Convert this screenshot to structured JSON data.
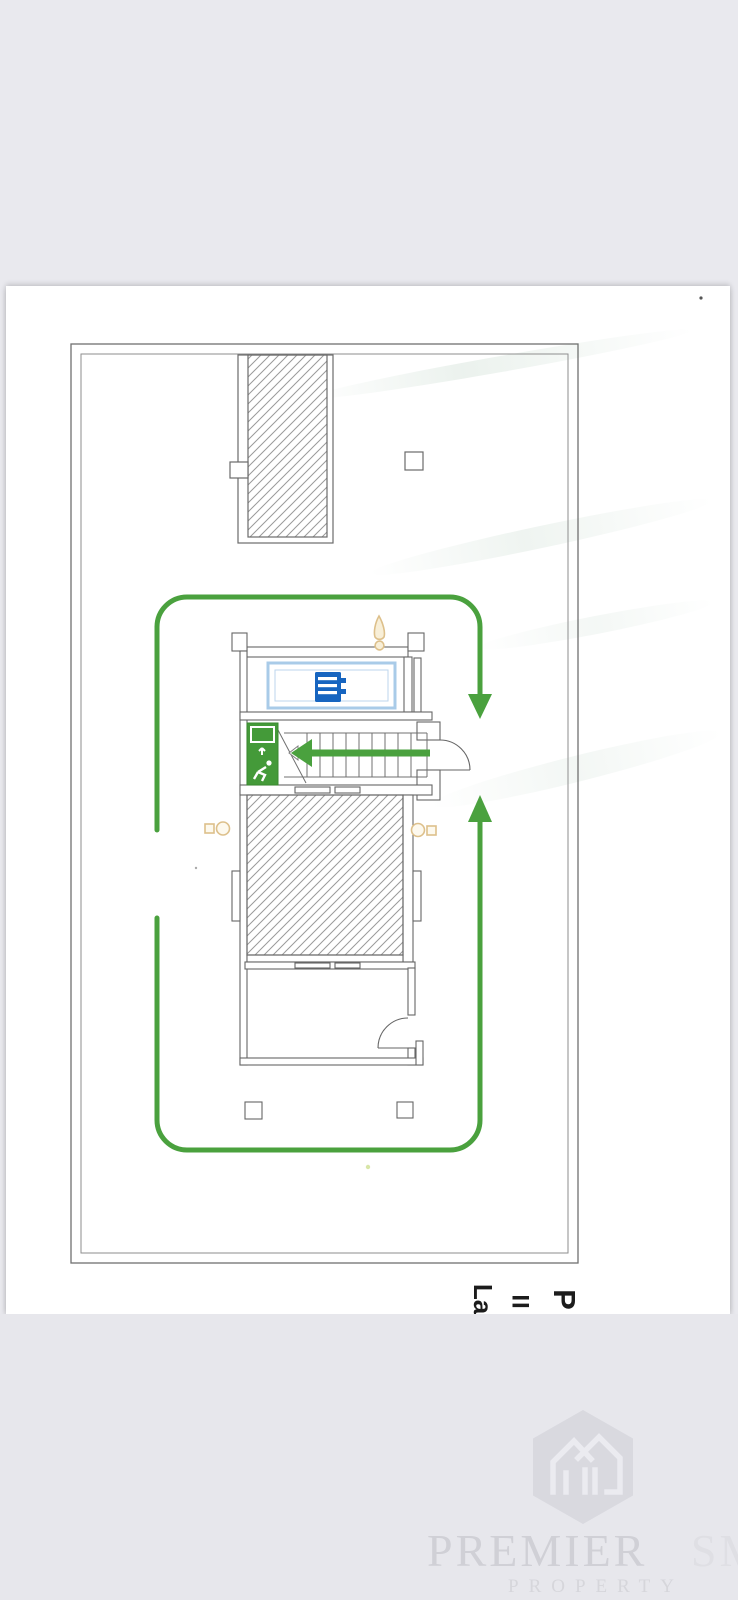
{
  "plan": {
    "rotated_title_fragments": {
      "la": "La",
      "ii": "II",
      "p": "P"
    },
    "icons": {
      "exit_sign": "emergency-exit-running-man",
      "pool": "pool-steps",
      "light_top": "ceiling-light",
      "light_left": "wall-light",
      "light_right": "wall-light"
    },
    "colors": {
      "route_green": "#4aa13e",
      "exit_sign_green": "#449a39",
      "pool_border_blue": "#a9cbe8",
      "pool_icon_blue": "#1765c0",
      "light_tan": "#ddc08b",
      "wall_line": "#666666"
    }
  },
  "watermark": {
    "brand_word1": "PREMIER",
    "brand_word2": "SMART",
    "brand_line2": "PROPERTY"
  }
}
